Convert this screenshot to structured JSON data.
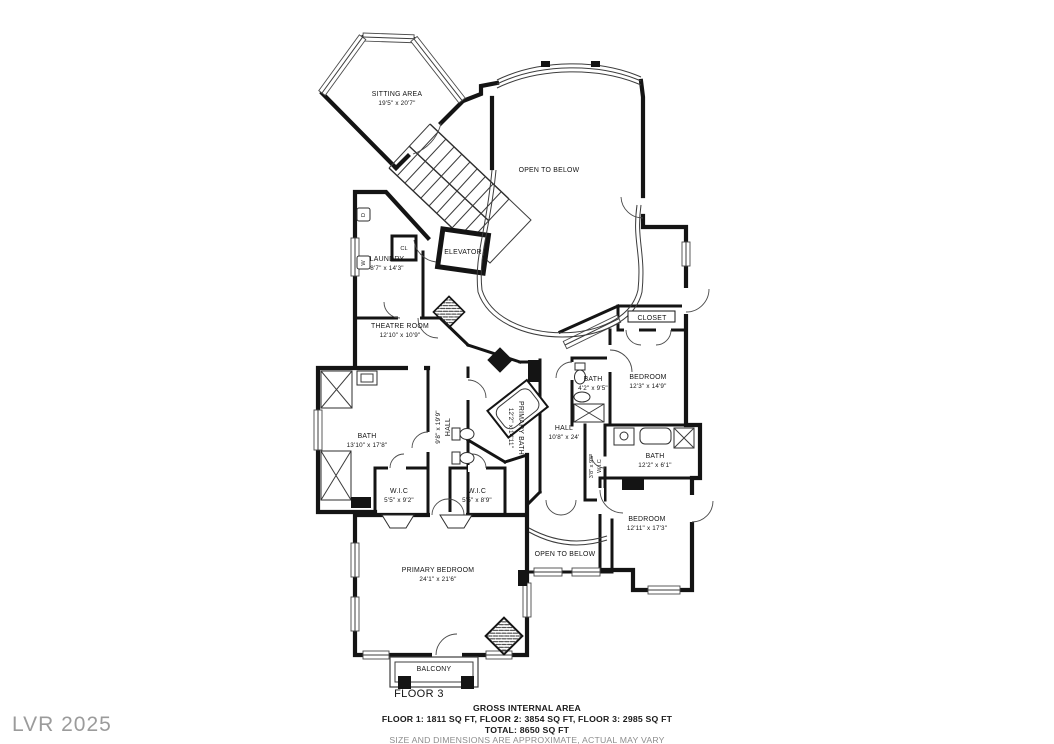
{
  "meta": {
    "floor_label": "FLOOR 3",
    "watermark": "LVR 2025"
  },
  "footer": {
    "title": "GROSS INTERNAL AREA",
    "floors_line": "FLOOR 1: 1811 SQ FT, FLOOR 2: 3854 SQ FT, FLOOR 3: 2985 SQ FT",
    "total_line": "TOTAL: 8650 SQ FT",
    "disclaimer": "SIZE AND DIMENSIONS ARE APPROXIMATE, ACTUAL MAY VARY"
  },
  "rooms": {
    "sitting": {
      "name": "SITTING AREA",
      "dims": "19'5\" x 20'7\""
    },
    "open_below_top": {
      "name": "OPEN TO BELOW"
    },
    "elevator": {
      "name": "ELEVATOR"
    },
    "laundry": {
      "name": "LAUNDRY",
      "dims": "8'7\" x 14'3\""
    },
    "cl": {
      "name": "CL"
    },
    "theatre": {
      "name": "THEATRE ROOM",
      "dims": "12'10\" x 10'9\""
    },
    "closet": {
      "name": "CLOSET"
    },
    "bedroom2": {
      "name": "BEDROOM",
      "dims": "12'3\" x 14'9\""
    },
    "bath2": {
      "name": "BATH",
      "dims": "4'2\" x 9'5\""
    },
    "hall_right": {
      "name": "HALL",
      "dims": "10'8\" x 24'"
    },
    "wic3": {
      "name": "W.I.C",
      "dims": "3'8\" x 9'5\""
    },
    "bath3": {
      "name": "BATH",
      "dims": "12'2\" x 6'1\""
    },
    "bedroom3": {
      "name": "BEDROOM",
      "dims": "12'11\" x 17'3\""
    },
    "bath_left": {
      "name": "BATH",
      "dims": "13'10\" x 17'8\""
    },
    "hall_left": {
      "name": "HALL",
      "dims": "9'8\" x 19'9\""
    },
    "primary_bath": {
      "name": "PRIMARY BATH",
      "dims": "12'2\" x 14'11\""
    },
    "wic1": {
      "name": "W.I.C",
      "dims": "5'5\" x 9'2\""
    },
    "wic2": {
      "name": "W.I.C",
      "dims": "5'5\" x 8'9\""
    },
    "open_below_bot": {
      "name": "OPEN TO BELOW"
    },
    "primary_bedroom": {
      "name": "PRIMARY BEDROOM",
      "dims": "24'1\" x 21'6\""
    },
    "balcony": {
      "name": "BALCONY"
    },
    "washer": {
      "name": "W"
    },
    "dryer": {
      "name": "D"
    }
  },
  "colors": {
    "wall": "#141414",
    "detail": "#3c3c3c",
    "watermark": "#9b9b9b",
    "disclaimer": "#8d8d8d"
  }
}
